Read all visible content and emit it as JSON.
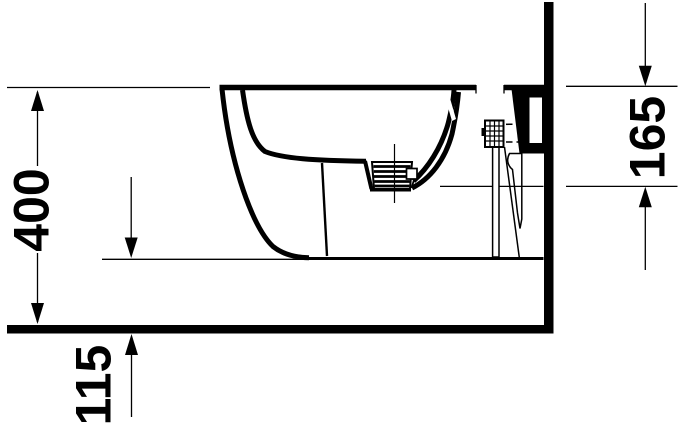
{
  "drawing": {
    "type": "technical-elevation",
    "dimensions": [
      {
        "id": "overall-height",
        "label": "400",
        "orientation": "vertical-left"
      },
      {
        "id": "rim-to-outlet-height",
        "label": "165",
        "orientation": "vertical-right"
      },
      {
        "id": "floor-clearance",
        "label": "115",
        "orientation": "vertical-bottom-left"
      }
    ]
  },
  "colors": {
    "ink": "#000000",
    "background": "#ffffff"
  }
}
